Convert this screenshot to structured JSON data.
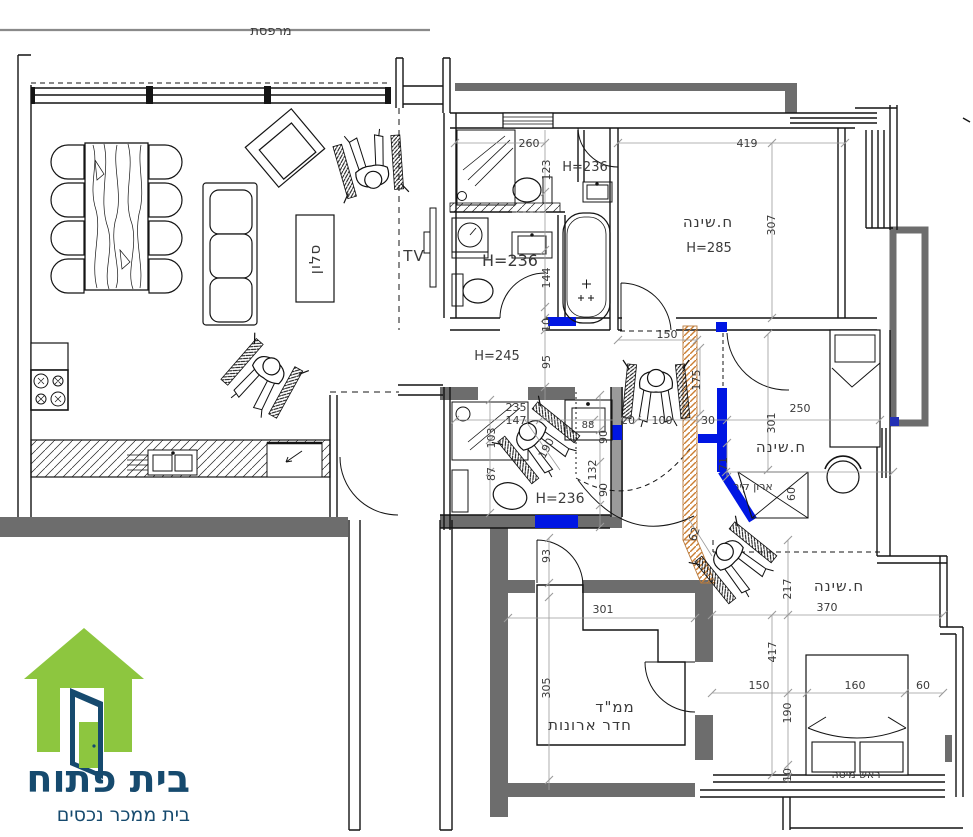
{
  "labels": {
    "balcony": "מרפסת",
    "living_room": "סלון",
    "tv": "TV",
    "bedroom_top": "ח.שינה",
    "bedroom_top_height": "H=285",
    "bedroom_mid": "ח.שינה",
    "bedroom_bottom": "ח.שינה",
    "bath_top_h1": "H=236",
    "bath_top_h2": "H=236",
    "bath_small_h": "H=236",
    "hall_h": "H=245",
    "closet": "ארון קיר",
    "safe_room1": "ממ\"ד",
    "safe_room2": "חדר ארונות",
    "bed_head": "ראש מיטה"
  },
  "dims": {
    "d260": "260",
    "d123": "123",
    "d419": "419",
    "d307": "307",
    "d150_hall": "150",
    "d175": "175",
    "d95": "95",
    "d10_bath": "10",
    "d144": "144",
    "d235": "235",
    "d147": "147",
    "d88": "88",
    "d20": "20",
    "d100": "100",
    "d30": "30",
    "d103": "103",
    "d87": "87",
    "d190_diag": "190",
    "d132": "132",
    "d90_a": "90",
    "d90_b": "90",
    "d250": "250",
    "d301_room": "301",
    "d71": "71",
    "d60_closet": "60",
    "d62": "62",
    "d93": "93",
    "d301_mamad": "301",
    "d305": "305",
    "d217": "217",
    "d370": "370",
    "d417": "417",
    "d150_bed": "150",
    "d160": "160",
    "d60_bed": "60",
    "d190_bed": "190",
    "d10_bed": "10"
  },
  "logo": {
    "brand": "בית פתוח",
    "tagline": "בית ממכר נכסים"
  },
  "colors": {
    "wall_gray": "#6d6d6d",
    "line": "#141414",
    "dim": "#9b9b9b",
    "text": "#3a3a3a",
    "new_wall_blue": "#0016e3",
    "demolish_orange": "#cc7f33",
    "logo_green": "#8dc63f",
    "logo_navy": "#164a6e"
  }
}
